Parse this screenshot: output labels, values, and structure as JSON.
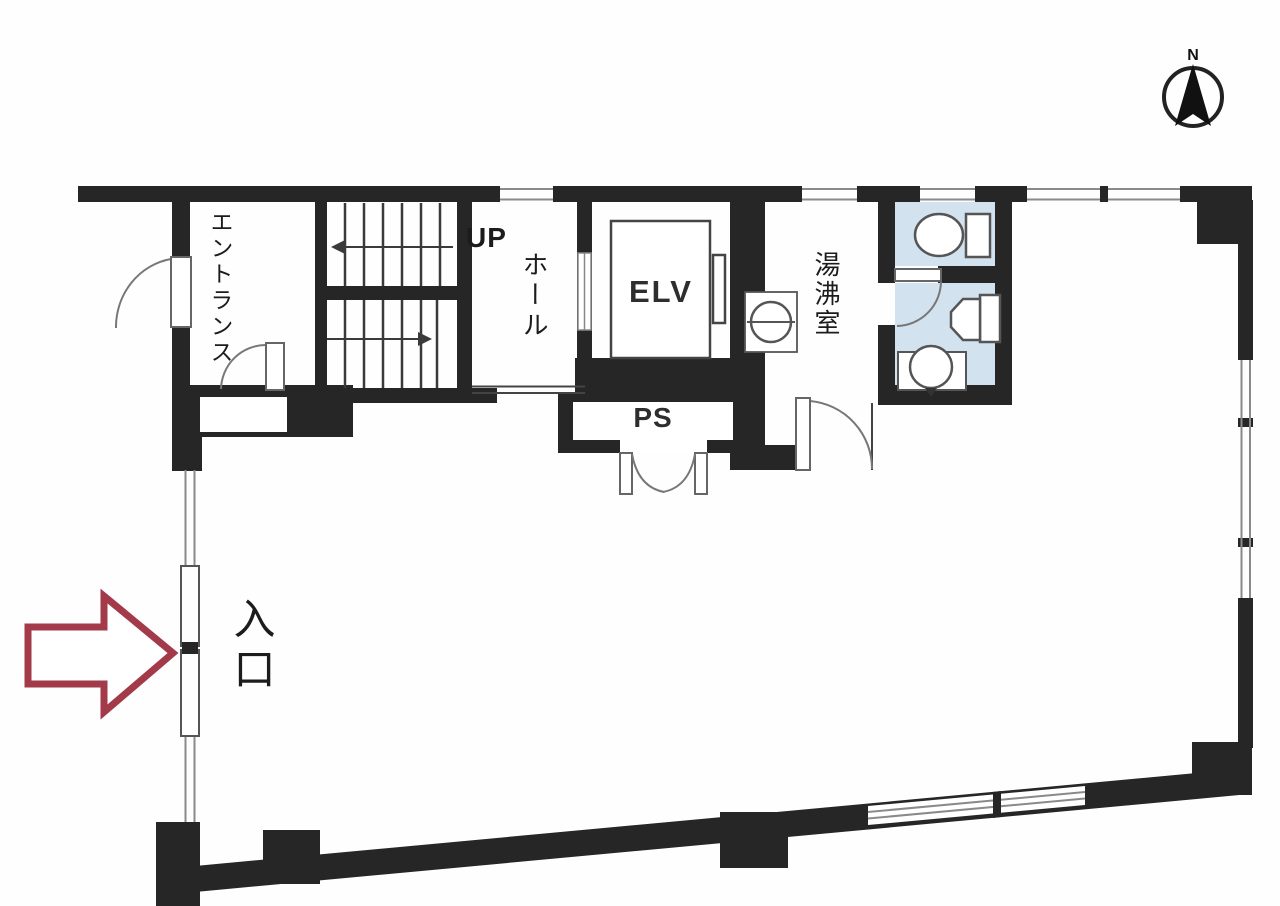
{
  "plan": {
    "type": "building-floor-plan",
    "labels": {
      "entrance": "エントランス",
      "stairs_up": "UP",
      "hall": "ホール",
      "elevator": "ELV",
      "pipe_space": "PS",
      "water_heating_room": "湯沸室",
      "entry": "入口",
      "north": "N"
    },
    "colors": {
      "wall": "#262626",
      "wet_area_fill": "#d3e2ef",
      "entry_arrow": "#a33a4a",
      "window_line": "#8a8a8a",
      "fixture_line": "#555555"
    }
  }
}
